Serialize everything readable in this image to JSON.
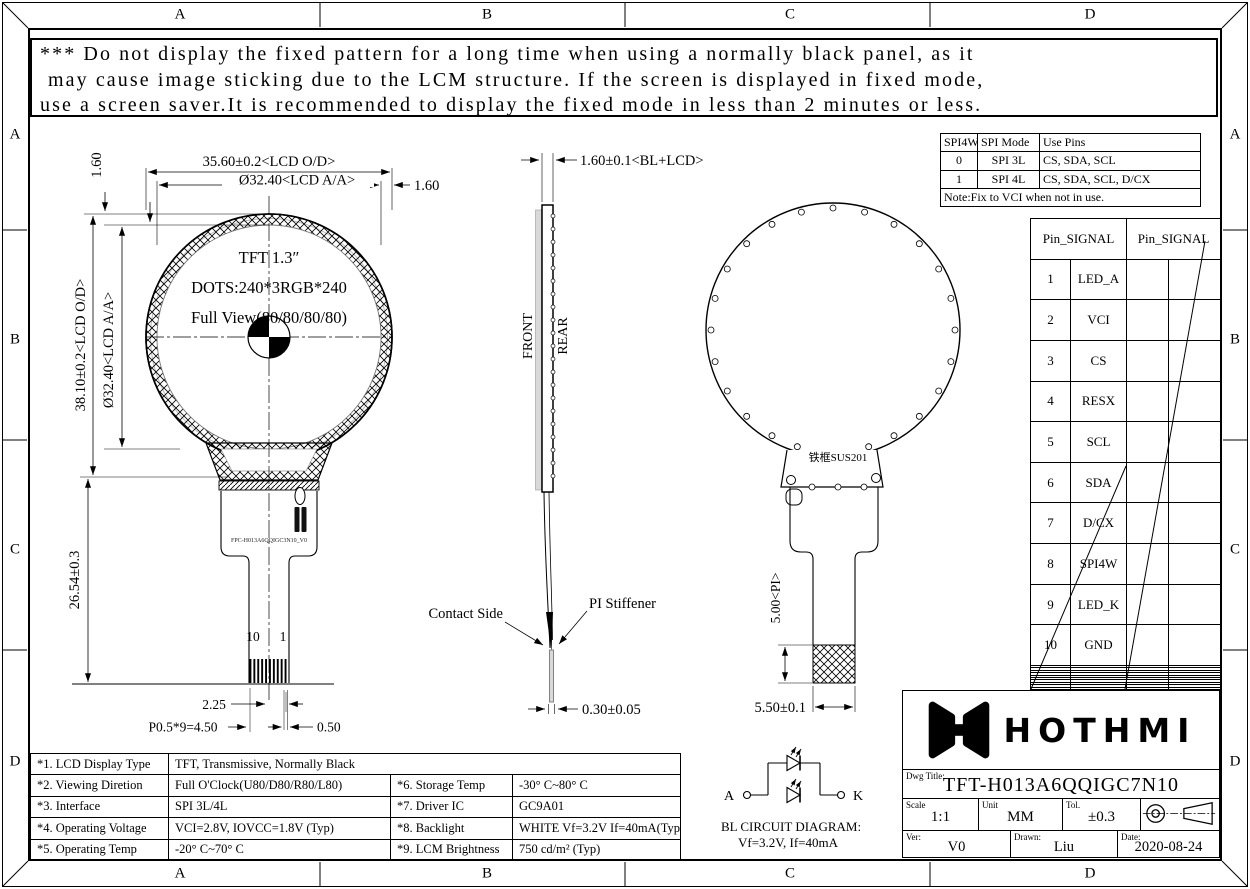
{
  "frame": {
    "zone_letters": [
      "A",
      "B",
      "C",
      "D"
    ]
  },
  "warning": {
    "line1": "*** Do not display the fixed pattern for a long time when using a normally black panel, as it",
    "line2": "may cause image sticking due to the LCM structure. If the screen is displayed in fixed mode,",
    "line3": "use a screen saver.It is recommended to display the fixed mode in less than 2 minutes or less."
  },
  "front_view": {
    "title": "TFT 1.3″",
    "dots": "DOTS:240*3RGB*240",
    "view": "Full View(80/80/80/80)",
    "dim_width_od": "35.60±0.2<LCD O/D>",
    "dim_width_aa": "Ø32.40<LCD A/A>",
    "dim_right_gap": "1.60",
    "dim_top_gap": "1.60",
    "dim_height_od": "38.10±0.2<LCD O/D>",
    "dim_height_aa": "Ø32.40<LCD A/A>",
    "dim_fpc_length": "26.54±0.3",
    "pin_left": "10",
    "pin_right": "1",
    "dim_tail_offset": "2.25",
    "dim_pitch": "P0.5*9=4.50",
    "dim_finger_width": "0.50",
    "fpc_part_no": "FPC-H013A6QQIGC3N10_V0"
  },
  "side_view": {
    "dim_thickness": "1.60±0.1<BL+LCD>",
    "front_label": "FRONT",
    "rear_label": "REAR",
    "contact_side": "Contact Side",
    "pi_stiffener": "PI Stiffener",
    "dim_fpc_thickness": "0.30±0.05"
  },
  "rear_view": {
    "frame_material": "铁框SUS201",
    "dim_pi": "5.00<PI>",
    "dim_tail_width": "5.50±0.1"
  },
  "bl_circuit": {
    "anode": "A",
    "cathode": "K",
    "caption1": "BL CIRCUIT DIAGRAM:",
    "caption2": "Vf=3.2V, If=40mA"
  },
  "spi_table": {
    "headers": [
      "SPI4W",
      "SPI Mode",
      "Use Pins"
    ],
    "rows": [
      [
        "0",
        "SPI 3L",
        "CS, SDA, SCL"
      ],
      [
        "1",
        "SPI 4L",
        "CS, SDA, SCL, D/CX"
      ]
    ],
    "note": "Note:Fix to VCI when not in use."
  },
  "pin_table": {
    "header": "Pin_SIGNAL",
    "pins": [
      [
        "1",
        "LED_A"
      ],
      [
        "2",
        "VCI"
      ],
      [
        "3",
        "CS"
      ],
      [
        "4",
        "RESX"
      ],
      [
        "5",
        "SCL"
      ],
      [
        "6",
        "SDA"
      ],
      [
        "7",
        "D/CX"
      ],
      [
        "8",
        "SPI4W"
      ],
      [
        "9",
        "LED_K"
      ],
      [
        "10",
        "GND"
      ]
    ]
  },
  "spec_table": {
    "rows": [
      [
        "*1. LCD Display Type",
        "TFT, Transmissive, Normally Black",
        "",
        ""
      ],
      [
        "*2. Viewing Diretion",
        "Full O'Clock(U80/D80/R80/L80)",
        "*6. Storage Temp",
        "-30° C~80° C"
      ],
      [
        "*3. Interface",
        "SPI 3L/4L",
        "*7. Driver IC",
        "GC9A01"
      ],
      [
        "*4. Operating Voltage",
        "VCI=2.8V, IOVCC=1.8V (Typ)",
        "*8. Backlight",
        "WHITE Vf=3.2V If=40mA(Typ)"
      ],
      [
        "*5. Operating Temp",
        "-20° C~70° C",
        "*9. LCM Brightness",
        "750 cd/m² (Typ)"
      ]
    ]
  },
  "title_block": {
    "logo_text": "HOTHMI",
    "dwg_title_label": "Dwg Title:",
    "dwg_title": "TFT-H013A6QQIGC7N10",
    "scale_label": "Scale",
    "scale": "1:1",
    "unit_label": "Unit",
    "unit": "MM",
    "tol_label": "Tol.",
    "tol": "±0.3",
    "ver_label": "Ver:",
    "ver": "V0",
    "drawn_label": "Drawn:",
    "drawn": "Liu",
    "date_label": "Date:",
    "date": "2020-08-24"
  }
}
